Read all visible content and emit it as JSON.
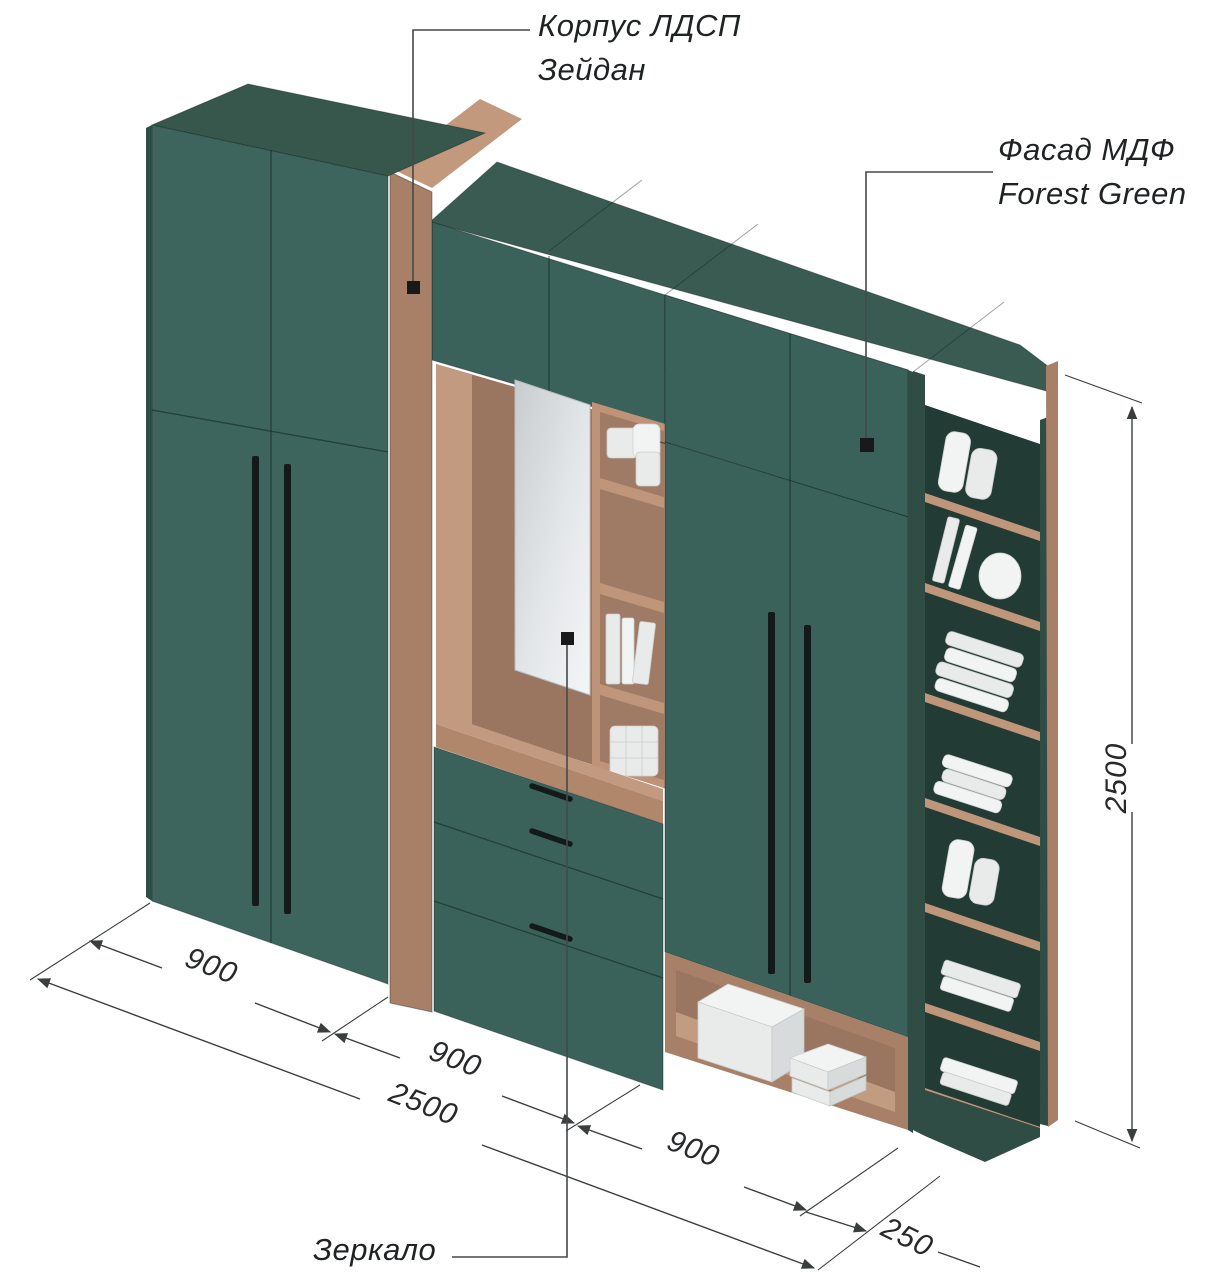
{
  "annotations": {
    "korpus": {
      "line1": "Корпус ЛДСП",
      "line2": "Зейдан"
    },
    "fasad": {
      "line1": "Фасад МДФ",
      "line2": "Forest Green"
    },
    "mirror": "Зеркало"
  },
  "dimensions": {
    "left_section_width": "900",
    "middle_section_width": "900",
    "right_section_width": "900",
    "total_width": "2500",
    "end_shelf_width": "250",
    "total_height": "2500"
  },
  "colors": {
    "facade_green": "#3b625a",
    "carcass_brown": "#a87f67",
    "handle_black": "#14191a",
    "annotation_line": "#3a3e3f"
  },
  "icons": {
    "leader_marker": "square"
  }
}
